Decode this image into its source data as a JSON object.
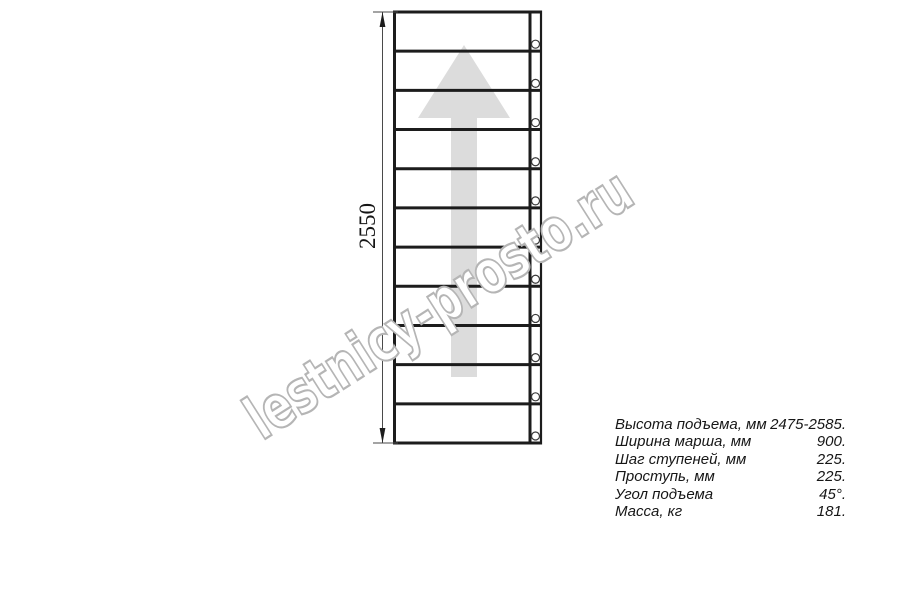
{
  "page": {
    "background": "#ffffff"
  },
  "drawing": {
    "type": "stair-flight-plan-view",
    "dimension": {
      "label": "2550"
    },
    "steps": {
      "count": 11
    },
    "direction_arrow": "up",
    "colors": {
      "line": "#1c1c1c",
      "thin_line": "#4a4a4a",
      "arrow_fill": "#dcdcdc",
      "watermark_stroke": "#b5b5b5",
      "text": "#161616"
    }
  },
  "watermark": {
    "text": "lestnicy-prosto.ru"
  },
  "specs": {
    "rows": [
      {
        "label": "Высота подъема, мм",
        "value": "2475-2585."
      },
      {
        "label": "Ширина марша, мм",
        "value": "900."
      },
      {
        "label": "Шаг ступеней, мм",
        "value": "225."
      },
      {
        "label": "Проступь, мм",
        "value": "225."
      },
      {
        "label": "Угол подъема",
        "value": "45°."
      },
      {
        "label": "Масса, кг",
        "value": "181."
      }
    ]
  }
}
